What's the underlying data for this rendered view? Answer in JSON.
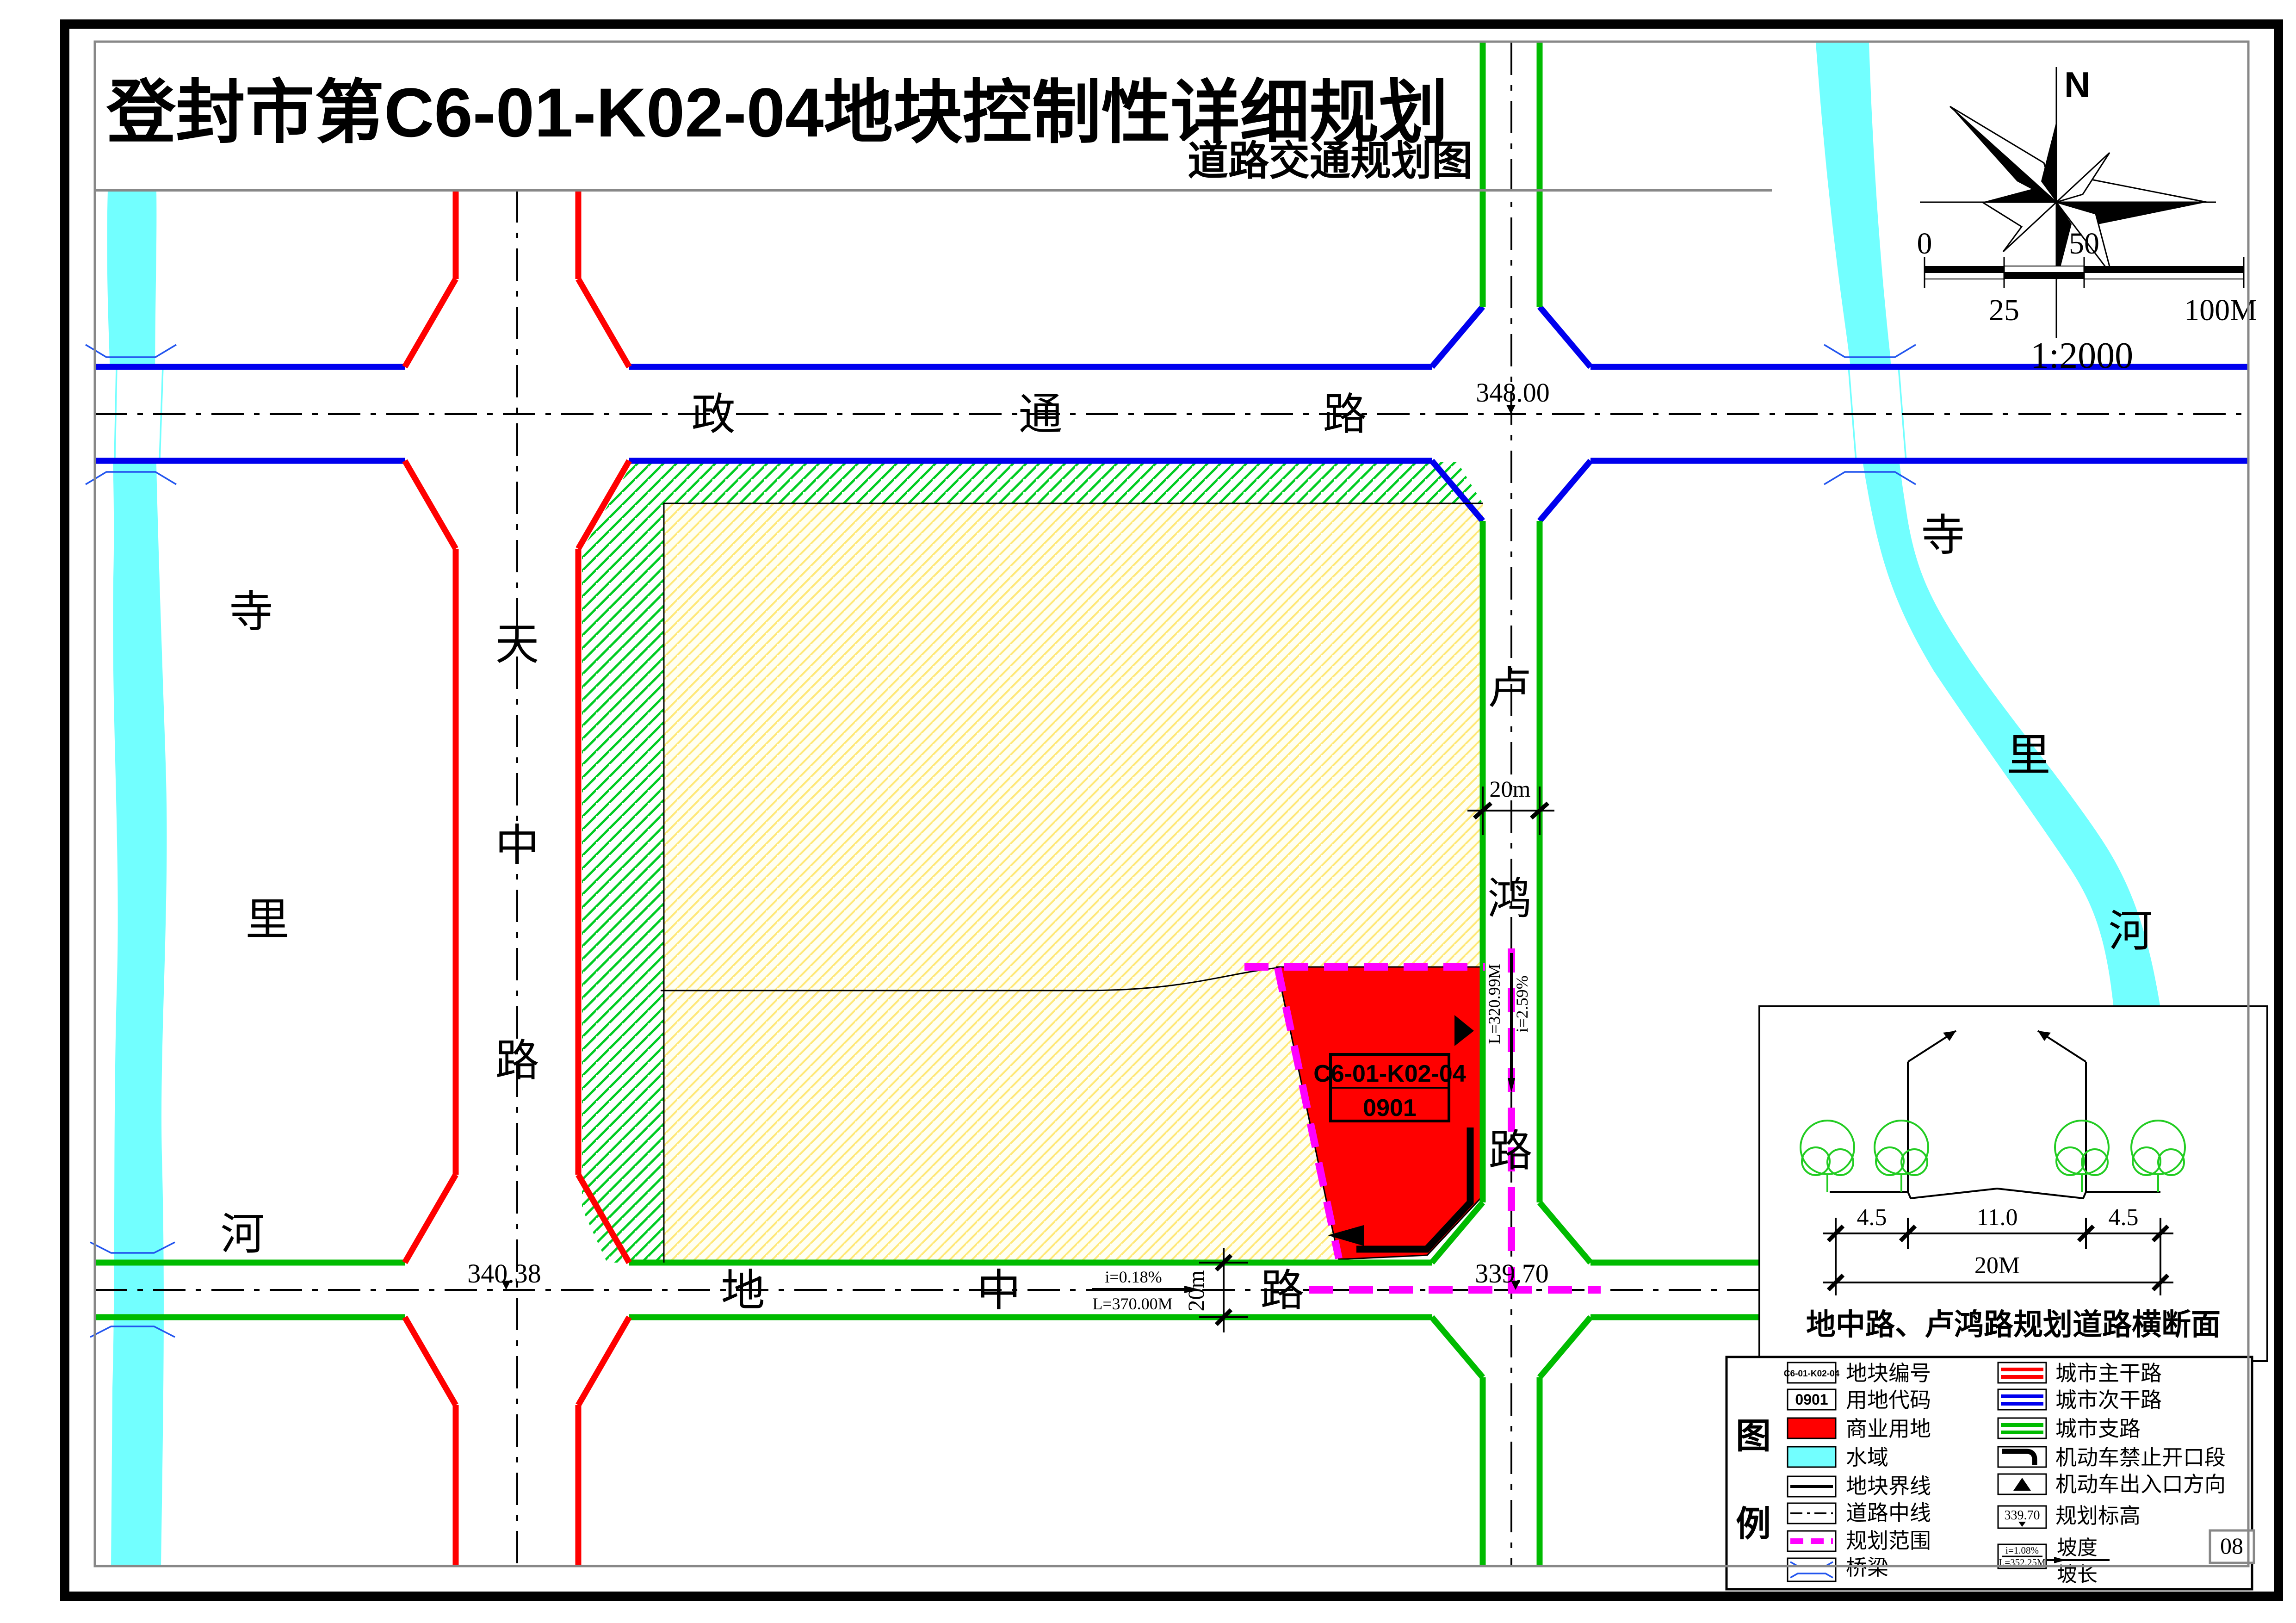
{
  "title": "登封市第C6-01-K02-04地块控制性详细规划",
  "subtitle": "道路交通规划图",
  "page_number": "08",
  "compass": {
    "north_label": "N"
  },
  "scale_bar": {
    "zero": "0",
    "twentyfive": "25",
    "fifty": "50",
    "hundred": "100M",
    "ratio": "1:2000"
  },
  "plot": {
    "code": "C6-01-K02-04",
    "use_code": "0901"
  },
  "roads": {
    "zhengtong": {
      "chars": [
        "政",
        "通",
        "路"
      ]
    },
    "dizhong": {
      "chars": [
        "地",
        "中",
        "路"
      ]
    },
    "tianzhong": {
      "chars": [
        "天",
        "中",
        "路"
      ]
    },
    "luhong": {
      "chars": [
        "卢",
        "鸿",
        "路"
      ]
    }
  },
  "rivers": {
    "left": {
      "chars": [
        "寺",
        "里",
        "河"
      ]
    },
    "right": {
      "chars": [
        "寺",
        "里",
        "河"
      ]
    }
  },
  "elevations": {
    "zhengtong_luhong": "348.00",
    "tianzhong_dizhong": "340.38",
    "luhong_dizhong": "339.70"
  },
  "slopes": {
    "dizhong": {
      "i": "i=0.18%",
      "l": "L=370.00M"
    },
    "luhong": {
      "i": "i=2.59%",
      "l": "L=320.99M"
    }
  },
  "dims": {
    "luhong_width": "20m",
    "dizhong_width": "20m"
  },
  "cross_section": {
    "dim_left": "4.5",
    "dim_mid": "11.0",
    "dim_right": "4.5",
    "dim_total": "20M",
    "title": "地中路、卢鸿路规划道路横断面"
  },
  "legend": {
    "title_chars": [
      "图",
      "例"
    ],
    "left": [
      {
        "label": "地块编号",
        "swatch_text": "C6-01-K02-04"
      },
      {
        "label": "用地代码",
        "swatch_text": "0901"
      },
      {
        "label": "商业用地"
      },
      {
        "label": "水域"
      },
      {
        "label": "地块界线"
      },
      {
        "label": "道路中线"
      },
      {
        "label": "规划范围"
      },
      {
        "label": "桥梁"
      }
    ],
    "right": [
      {
        "label": "城市主干路"
      },
      {
        "label": "城市次干路"
      },
      {
        "label": "城市支路"
      },
      {
        "label": "机动车禁止开口段"
      },
      {
        "label": "机动车出入口方向"
      },
      {
        "label": "规划标高",
        "swatch_text": "339.70"
      },
      {
        "label": "坡度",
        "label2": "坡长",
        "swatch_i": "i=1.08%",
        "swatch_l": "L=352.25M"
      }
    ]
  },
  "colors": {
    "commercial": "#FF0000",
    "water": "#72FFFF",
    "main_road": "#FF0000",
    "secondary_road": "#0000EE",
    "branch_road": "#00BB00",
    "planning_boundary": "#FF00FF",
    "green_hatch": "#00CC22",
    "yellow_hatch": "#FFE878"
  }
}
